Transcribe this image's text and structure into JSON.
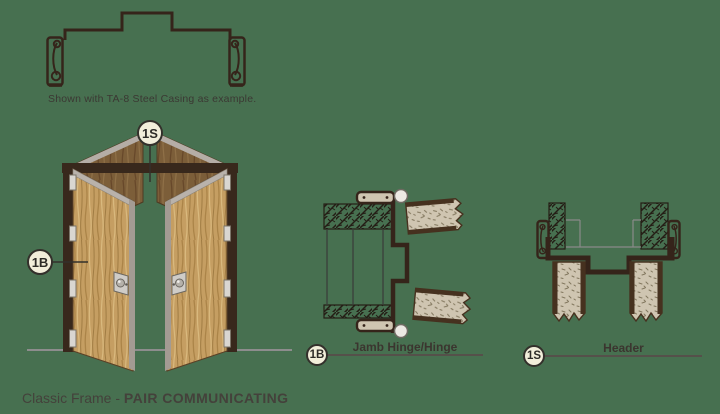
{
  "title": {
    "prefix": "Classic Frame -",
    "emphasis": "PAIR COMMUNICATING"
  },
  "note": "Shown with TA-8 Steel Casing as example.",
  "door_view": {
    "header_callout": "1S",
    "jamb_callout": "1B"
  },
  "details": {
    "jamb": {
      "callout": "1B",
      "label": "Jamb Hinge/Hinge"
    },
    "header": {
      "callout": "1S",
      "label": "Header"
    }
  },
  "colors": {
    "background": "#477050",
    "frame_brown": "#35241a",
    "door_wood": "#c59e62",
    "section_fill": "#cfc5b1",
    "callout_bg": "#f2eeda",
    "text": "#3b3833"
  }
}
